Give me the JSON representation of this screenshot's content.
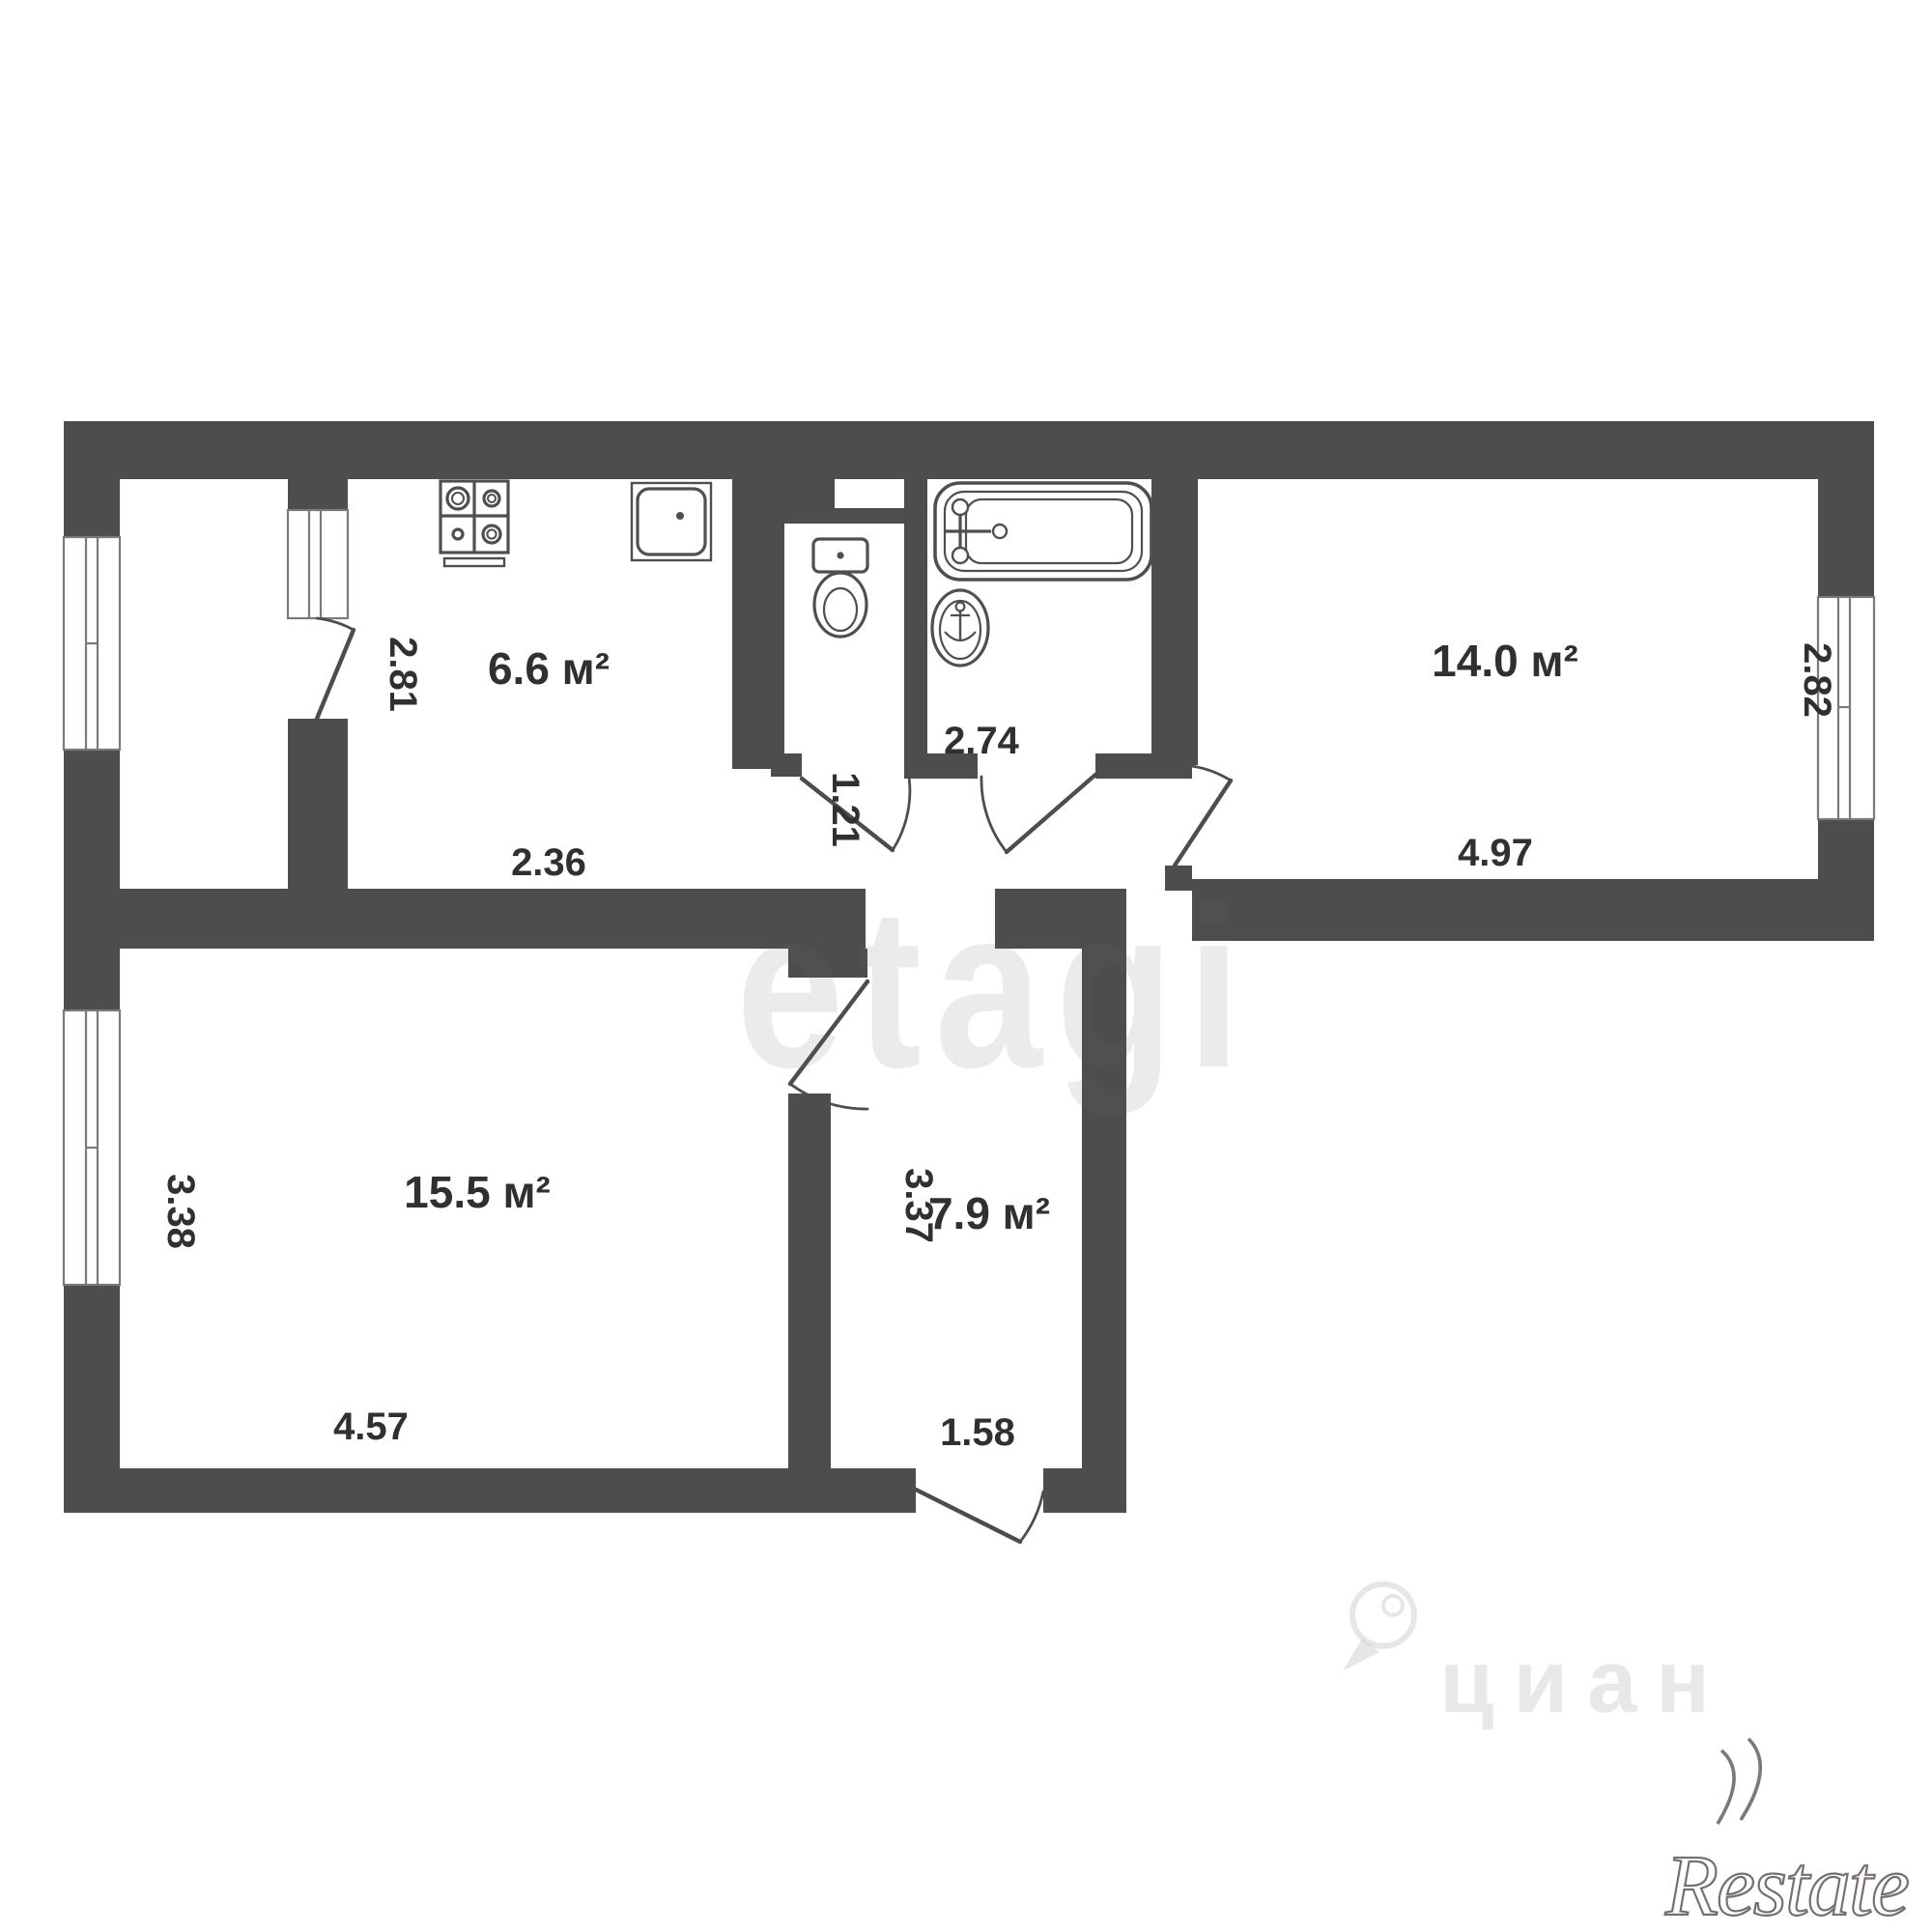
{
  "rooms": {
    "kitchen": {
      "label": "6.6 м²"
    },
    "bedroom": {
      "label": "14.0 м²"
    },
    "living": {
      "label": "15.5 м²"
    },
    "hallway": {
      "label": "7.9 м²"
    }
  },
  "dims": {
    "d281": "2.81",
    "d236": "2.36",
    "d121": "1.21",
    "d274": "2.74",
    "d497": "4.97",
    "d282": "2.82",
    "d338": "3.38",
    "d457": "4.57",
    "d337": "3.37",
    "d158": "1.58"
  },
  "fixtures": [
    "stove",
    "kitchen-sink",
    "toilet",
    "bathtub",
    "wash-basin"
  ],
  "watermarks": {
    "center": "etagi",
    "agency": "циан",
    "corner": "Restate"
  },
  "colors": {
    "wall": "#4d4d4d",
    "text": "#303030",
    "fixture": "#4f4f4f",
    "background": "#ffffff"
  }
}
